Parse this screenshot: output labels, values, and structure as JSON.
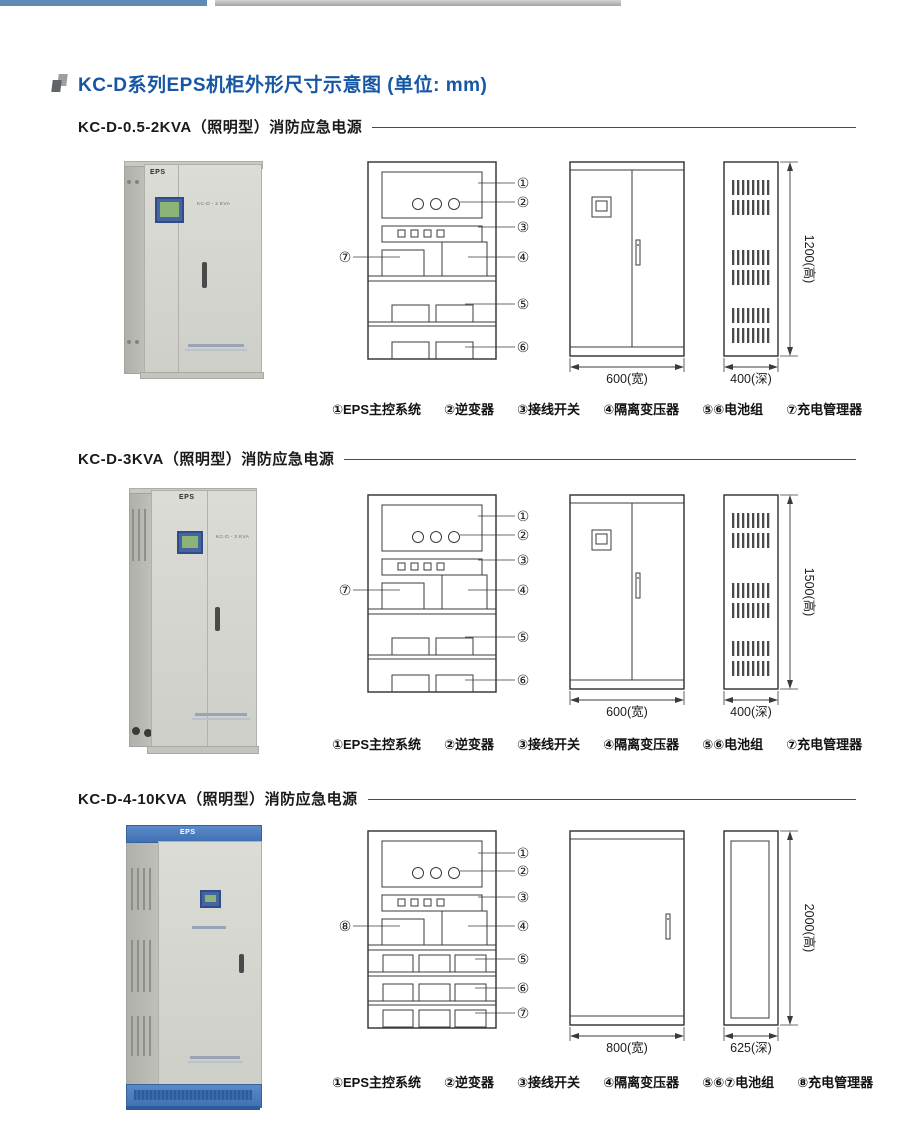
{
  "header": {
    "title": "KC-D系列EPS机柜外形尺寸示意图 (单位: mm)",
    "title_color": "#1557a5",
    "bullet_icon": "overlapping-squares-icon",
    "top_bar_blue": "#5f8ab8",
    "top_bar_gray": "#b6b6b6"
  },
  "sections": [
    {
      "title": "KC-D-0.5-2KVA（照明型）消防应急电源",
      "photo": {
        "brand": "EPS",
        "model": "KC-D - 2 KVA"
      },
      "diagram": {
        "left_callout": "⑦",
        "right_callouts": [
          "①",
          "②",
          "③",
          "④",
          "⑤",
          "⑥"
        ],
        "battery_rows": 2,
        "front_view": {
          "double_door": true,
          "has_display": true,
          "width_label": "600(宽)"
        },
        "back_view": {
          "style": "vents",
          "depth_label": "400(深)",
          "height_label": "1200(高)"
        }
      },
      "legend": [
        "①EPS主控系统",
        "②逆变器",
        "③接线开关",
        "④隔离变压器",
        "⑤⑥电池组",
        "⑦充电管理器"
      ]
    },
    {
      "title": "KC-D-3KVA（照明型）消防应急电源",
      "photo": {
        "brand": "EPS",
        "model": "KC-D - 3 KVA"
      },
      "diagram": {
        "left_callout": "⑦",
        "right_callouts": [
          "①",
          "②",
          "③",
          "④",
          "⑤",
          "⑥"
        ],
        "battery_rows": 2,
        "front_view": {
          "double_door": true,
          "has_display": true,
          "width_label": "600(宽)"
        },
        "back_view": {
          "style": "vents",
          "depth_label": "400(深)",
          "height_label": "1500(高)"
        }
      },
      "legend": [
        "①EPS主控系统",
        "②逆变器",
        "③接线开关",
        "④隔离变压器",
        "⑤⑥电池组",
        "⑦充电管理器"
      ]
    },
    {
      "title": "KC-D-4-10KVA（照明型）消防应急电源",
      "photo": {
        "brand": "EPS",
        "model": ""
      },
      "diagram": {
        "left_callout": "⑧",
        "right_callouts": [
          "①",
          "②",
          "③",
          "④",
          "⑤",
          "⑥",
          "⑦"
        ],
        "battery_rows": 3,
        "front_view": {
          "double_door": false,
          "has_display": false,
          "width_label": "800(宽)"
        },
        "back_view": {
          "style": "panel",
          "depth_label": "625(深)",
          "height_label": "2000(高)"
        }
      },
      "legend": [
        "①EPS主控系统",
        "②逆变器",
        "③接线开关",
        "④隔离变压器",
        "⑤⑥⑦电池组",
        "⑧充电管理器"
      ]
    }
  ]
}
